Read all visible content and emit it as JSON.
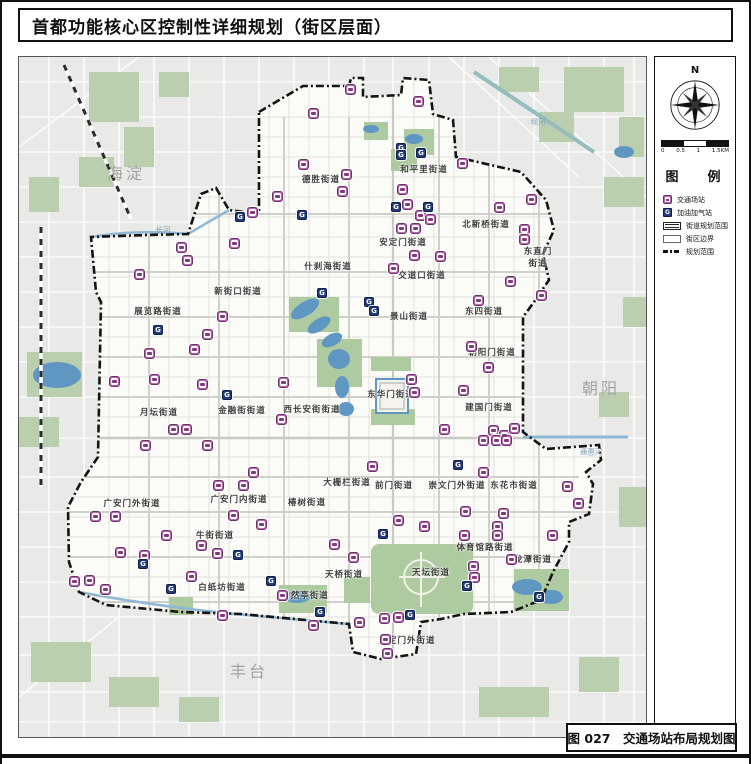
{
  "page": {
    "title": "首都功能核心区控制性详细规划（街区层面）",
    "caption": "图 027　交通场站布局规划图"
  },
  "legend": {
    "title": "图　例",
    "compass_label": "N",
    "scale_labels": [
      "0",
      "0.5",
      "1",
      "1.5KM"
    ],
    "items": [
      {
        "type": "station",
        "label": "交通场站"
      },
      {
        "type": "gas",
        "label": "加油加气站"
      },
      {
        "type": "drect",
        "label": "街道规划范围"
      },
      {
        "type": "rect",
        "label": "街区边界"
      },
      {
        "type": "dashdot",
        "label": "规划范围"
      }
    ]
  },
  "map": {
    "colors": {
      "outside": "#e9e9e7",
      "core": "#fbfbf8",
      "park": "#aecaa0",
      "water": "#5f97c2",
      "boundary": "#141414",
      "station": "#b668b0",
      "gas": "#223a75"
    },
    "gas_glyph": "G",
    "district_labels": [
      {
        "text": "海淀",
        "x": 107,
        "y": 115
      },
      {
        "text": "朝阳",
        "x": 582,
        "y": 330
      },
      {
        "text": "丰台",
        "x": 230,
        "y": 613
      }
    ],
    "subdistrict_labels": [
      {
        "text": "德胜街道",
        "x": 302,
        "y": 122
      },
      {
        "text": "和平里街道",
        "x": 405,
        "y": 112
      },
      {
        "text": "北新桥街道",
        "x": 467,
        "y": 167
      },
      {
        "text": "安定门街道",
        "x": 384,
        "y": 185
      },
      {
        "text": "东直门\n街道",
        "x": 519,
        "y": 200
      },
      {
        "text": "交道口街道",
        "x": 403,
        "y": 218
      },
      {
        "text": "什刹海街道",
        "x": 309,
        "y": 209
      },
      {
        "text": "新街口街道",
        "x": 219,
        "y": 234
      },
      {
        "text": "展览路街道",
        "x": 139,
        "y": 254
      },
      {
        "text": "景山街道",
        "x": 390,
        "y": 259
      },
      {
        "text": "东四街道",
        "x": 465,
        "y": 254
      },
      {
        "text": "朝阳门街道",
        "x": 473,
        "y": 295
      },
      {
        "text": "东华门街道",
        "x": 372,
        "y": 337
      },
      {
        "text": "西长安街街道",
        "x": 293,
        "y": 352
      },
      {
        "text": "金融街街道",
        "x": 223,
        "y": 353
      },
      {
        "text": "月坛街道",
        "x": 140,
        "y": 355
      },
      {
        "text": "建国门街道",
        "x": 470,
        "y": 350
      },
      {
        "text": "大栅栏街道",
        "x": 328,
        "y": 425
      },
      {
        "text": "前门街道",
        "x": 375,
        "y": 428
      },
      {
        "text": "崇文门外街道",
        "x": 438,
        "y": 428
      },
      {
        "text": "东花市街道",
        "x": 495,
        "y": 428
      },
      {
        "text": "广安门外街道",
        "x": 113,
        "y": 446
      },
      {
        "text": "广安门内街道",
        "x": 220,
        "y": 442
      },
      {
        "text": "椿树街道",
        "x": 288,
        "y": 445
      },
      {
        "text": "牛街街道",
        "x": 196,
        "y": 478
      },
      {
        "text": "白纸坊街道",
        "x": 203,
        "y": 530
      },
      {
        "text": "天桥街道",
        "x": 325,
        "y": 517
      },
      {
        "text": "陶然亭街道",
        "x": 286,
        "y": 538
      },
      {
        "text": "体育馆路街道",
        "x": 466,
        "y": 490
      },
      {
        "text": "龙潭街道",
        "x": 514,
        "y": 502
      },
      {
        "text": "天坛街道",
        "x": 412,
        "y": 515
      },
      {
        "text": "永定门外街道",
        "x": 388,
        "y": 583
      }
    ],
    "water_labels": [
      {
        "text": "长河",
        "x": 144,
        "y": 173
      },
      {
        "text": "坝河",
        "x": 519,
        "y": 65
      },
      {
        "text": "通惠河",
        "x": 572,
        "y": 395
      }
    ],
    "stations": [
      [
        331,
        32
      ],
      [
        399,
        44
      ],
      [
        294,
        56
      ],
      [
        284,
        107
      ],
      [
        327,
        117
      ],
      [
        323,
        134
      ],
      [
        258,
        139
      ],
      [
        443,
        106
      ],
      [
        383,
        132
      ],
      [
        233,
        155
      ],
      [
        215,
        186
      ],
      [
        162,
        190
      ],
      [
        168,
        203
      ],
      [
        388,
        147
      ],
      [
        401,
        158
      ],
      [
        411,
        162
      ],
      [
        382,
        171
      ],
      [
        396,
        171
      ],
      [
        395,
        198
      ],
      [
        421,
        199
      ],
      [
        374,
        211
      ],
      [
        480,
        150
      ],
      [
        512,
        142
      ],
      [
        505,
        172
      ],
      [
        505,
        182
      ],
      [
        120,
        217
      ],
      [
        491,
        224
      ],
      [
        203,
        259
      ],
      [
        188,
        277
      ],
      [
        130,
        296
      ],
      [
        175,
        292
      ],
      [
        459,
        243
      ],
      [
        522,
        238
      ],
      [
        452,
        289
      ],
      [
        469,
        310
      ],
      [
        264,
        325
      ],
      [
        95,
        324
      ],
      [
        135,
        322
      ],
      [
        183,
        327
      ],
      [
        262,
        362
      ],
      [
        154,
        372
      ],
      [
        167,
        372
      ],
      [
        392,
        322
      ],
      [
        395,
        335
      ],
      [
        444,
        333
      ],
      [
        425,
        372
      ],
      [
        474,
        373
      ],
      [
        485,
        378
      ],
      [
        495,
        371
      ],
      [
        464,
        383
      ],
      [
        477,
        383
      ],
      [
        487,
        383
      ],
      [
        464,
        415
      ],
      [
        353,
        409
      ],
      [
        126,
        388
      ],
      [
        188,
        388
      ],
      [
        234,
        415
      ],
      [
        199,
        428
      ],
      [
        224,
        428
      ],
      [
        76,
        459
      ],
      [
        96,
        459
      ],
      [
        214,
        458
      ],
      [
        242,
        467
      ],
      [
        147,
        478
      ],
      [
        101,
        495
      ],
      [
        125,
        498
      ],
      [
        182,
        488
      ],
      [
        198,
        496
      ],
      [
        379,
        463
      ],
      [
        405,
        469
      ],
      [
        446,
        454
      ],
      [
        484,
        456
      ],
      [
        478,
        469
      ],
      [
        478,
        478
      ],
      [
        445,
        478
      ],
      [
        548,
        429
      ],
      [
        559,
        446
      ],
      [
        533,
        478
      ],
      [
        492,
        502
      ],
      [
        454,
        509
      ],
      [
        455,
        520
      ],
      [
        70,
        523
      ],
      [
        55,
        524
      ],
      [
        86,
        532
      ],
      [
        172,
        519
      ],
      [
        203,
        558
      ],
      [
        263,
        538
      ],
      [
        294,
        568
      ],
      [
        315,
        487
      ],
      [
        334,
        500
      ],
      [
        340,
        565
      ],
      [
        365,
        561
      ],
      [
        379,
        560
      ],
      [
        366,
        582
      ],
      [
        368,
        596
      ]
    ],
    "gas_stations": [
      [
        221,
        160
      ],
      [
        283,
        158
      ],
      [
        382,
        91
      ],
      [
        382,
        98
      ],
      [
        402,
        96
      ],
      [
        377,
        150
      ],
      [
        409,
        150
      ],
      [
        303,
        236
      ],
      [
        350,
        245
      ],
      [
        355,
        254
      ],
      [
        139,
        273
      ],
      [
        208,
        338
      ],
      [
        364,
        477
      ],
      [
        439,
        408
      ],
      [
        219,
        498
      ],
      [
        124,
        507
      ],
      [
        152,
        532
      ],
      [
        252,
        524
      ],
      [
        301,
        555
      ],
      [
        391,
        558
      ],
      [
        448,
        529
      ],
      [
        520,
        540
      ]
    ]
  }
}
